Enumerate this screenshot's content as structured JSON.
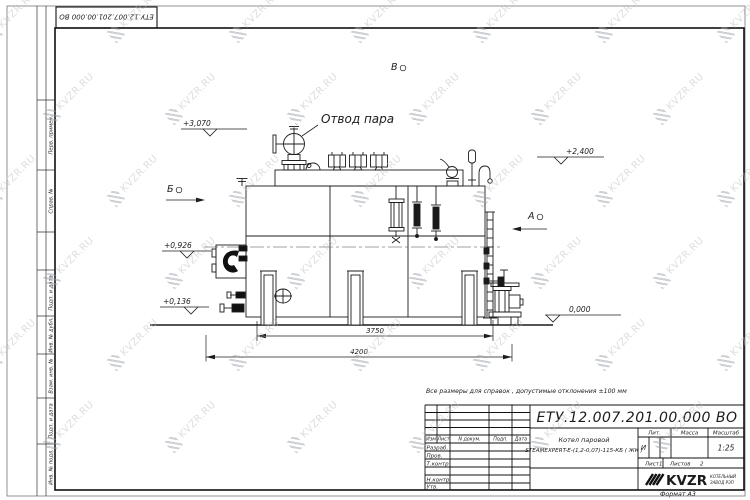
{
  "frame": {
    "doc_number": "ЕТУ.12.007.201.00.000  ВО",
    "format": "Формат А3",
    "note": "Все размеры для справок , допустимые отклонения  ±100 мм"
  },
  "margin": {
    "labels": [
      "Перв. примен.",
      "Справ. №",
      "Подп. и дата",
      "Инв. № дубл.",
      "Взам. инв. №",
      "Подп. и дата",
      "Инв. № подл."
    ]
  },
  "stamp": {
    "header_cols": [
      "Изм",
      "Лист",
      "N докум.",
      "Подп.",
      "Дата"
    ],
    "sig_rows": [
      "Разраб.",
      "Пров.",
      "Т.контр",
      "",
      "Н.контр",
      "Утв."
    ],
    "product_name_line1": "Котел паровой",
    "product_name_line2": "STEAMEXPERT-Е-(1,2-0,07)-115-КБ ( ЖК )",
    "lit_label": "Лит.",
    "lit_value": "И",
    "mass_label": "Масса",
    "mass_value": "",
    "scale_label": "Масштаб",
    "scale_value": "1:25",
    "sheet_label": "Лист",
    "sheet_no": "1",
    "sheets_label": "Листов",
    "sheets_total": "2",
    "logo_text": "KVZR",
    "logo_sub1": "КОТЕЛЬНЫЙ",
    "logo_sub2": "ЗАВОД РЭП"
  },
  "drawing": {
    "steam_outlet_label": "Отвод пара",
    "marker_a": "А",
    "marker_b": "Б",
    "marker_v": "В",
    "elev_3070": "+3,070",
    "elev_2400": "+2,400",
    "elev_0926": "+0,926",
    "elev_0136": "+0,136",
    "elev_0000": "0,000",
    "dim_3750": "3750",
    "dim_4200": "4200"
  },
  "watermark": {
    "text": "KVZR.RU"
  }
}
